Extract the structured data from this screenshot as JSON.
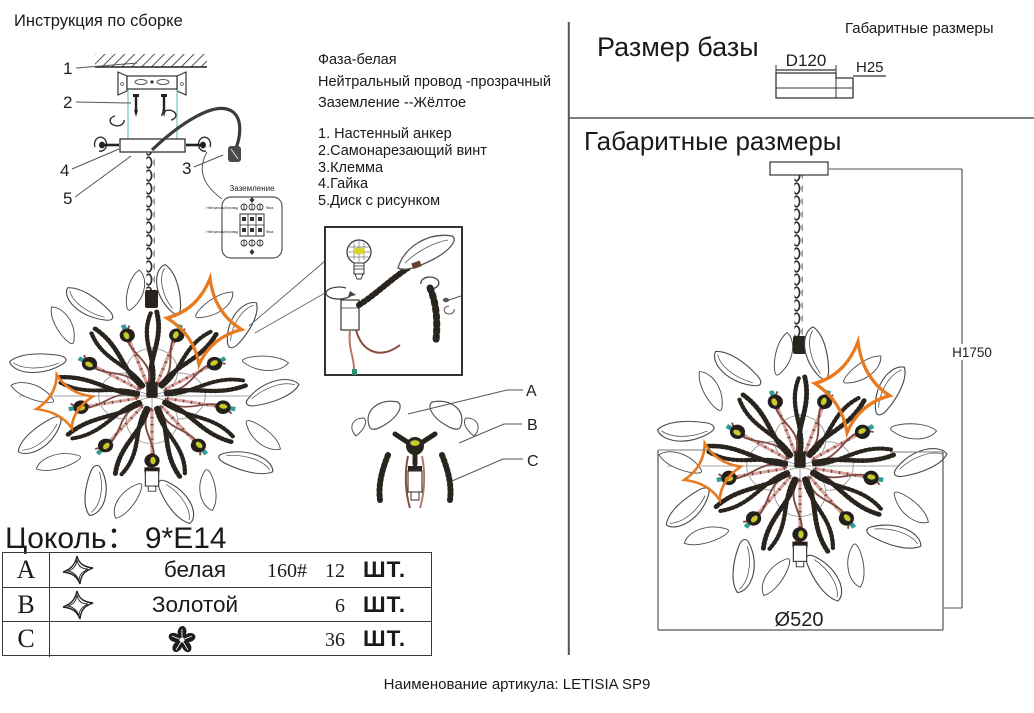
{
  "title": "Инструкция по сборке",
  "wiring": {
    "phase": "Фаза-белая",
    "neutral": "Нейтральный провод -прозрачный",
    "ground": "Заземление --Жёлтое"
  },
  "parts": [
    "1. Настенный анкер",
    "2.Самонарезающий винт",
    "3.Клемма",
    "4.Гайка",
    "5.Диск с рисунком"
  ],
  "callouts": {
    "c1": "1",
    "c2": "2",
    "c3": "3",
    "c4": "4",
    "c5": "5"
  },
  "grounding_box": {
    "title": "Заземление",
    "left_label": "Нейтральный провод",
    "right_label": "Фаза"
  },
  "detail_refs": {
    "a": "A",
    "b": "B",
    "c": "C"
  },
  "size_panel": {
    "corner_title": "Габаритные размеры",
    "title": "Размер базы",
    "diameter": "D120",
    "height": "H25"
  },
  "overall_panel": {
    "title": "Габаритные размеры",
    "height_dim": "H1750",
    "diameter_dim": "Ø520"
  },
  "socket_table": {
    "title": "Цоколь： 9*E14",
    "rows": [
      {
        "letter": "A",
        "icon": "twisted-star",
        "name": "белая",
        "size": "160#",
        "qty": "12",
        "unit": "ШТ."
      },
      {
        "letter": "B",
        "icon": "twisted-star",
        "name": "Золотой",
        "size": "",
        "qty": "6",
        "unit": "ШТ."
      },
      {
        "letter": "C",
        "icon": "flower",
        "name": "",
        "size": "",
        "qty": "36",
        "unit": "ШТ."
      }
    ]
  },
  "footer": "Наименование артикула: LETISIA SP9",
  "colors": {
    "accent_orange": "#e87a20",
    "bulb_yellow": "#c9ce25",
    "wire_maroon": "#7d4a42",
    "rod_pink": "#d8a39a",
    "guide_cyan": "#70c9c9",
    "line_dark": "#2a241f"
  }
}
